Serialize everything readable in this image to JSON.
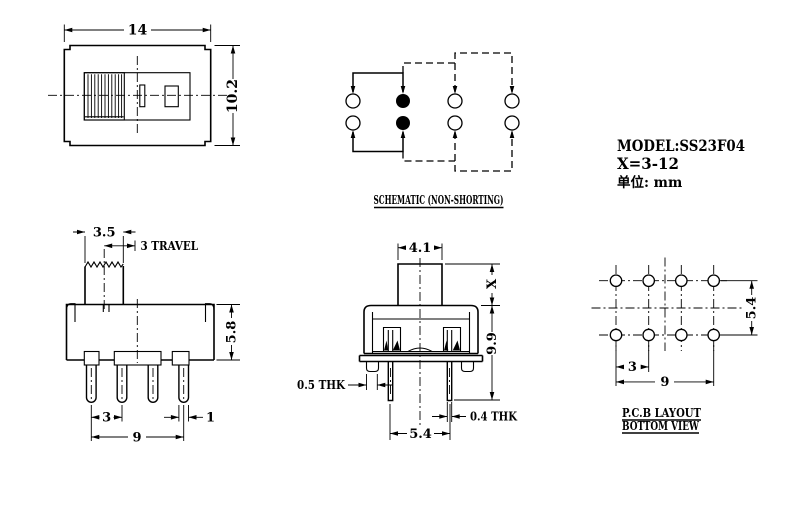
{
  "drawing": {
    "top_view": {
      "dim_width": "14",
      "dim_height": "10.2"
    },
    "schematic": {
      "label": "SCHEMATIC (NON-SHORTING)"
    },
    "title_block": {
      "model": "MODEL:SS23F04",
      "x_range": "X=3-12",
      "unit": "单位: mm"
    },
    "front_view": {
      "dim_knob_width": "3.5",
      "dim_travel": "3 TRAVEL",
      "dim_body_height": "5.8",
      "dim_pin_pitch": "3",
      "dim_pin_width": "1",
      "dim_pin_span": "9"
    },
    "side_view": {
      "dim_stem_width": "4.1",
      "dim_stem_height": "X",
      "dim_body_height": "9.9",
      "dim_bracket_thk": "0.5 THK",
      "dim_pin_thk": "0.4 THK",
      "dim_pin_spacing": "5.4"
    },
    "pcb_layout": {
      "title_line1": "P.C.B LAYOUT",
      "title_line2": "BOTTOM VIEW",
      "dim_row_spacing": "5.4",
      "dim_hole_pitch": "3",
      "dim_hole_span": "9"
    }
  }
}
